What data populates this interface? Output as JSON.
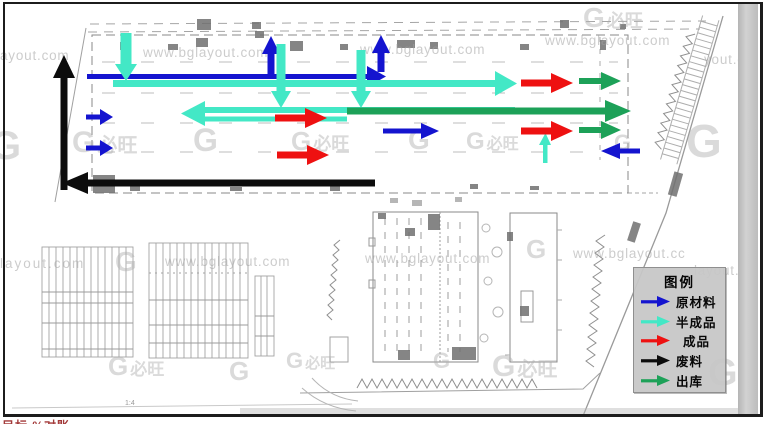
{
  "legend": {
    "title": "图例",
    "items": [
      {
        "key": "raw_material",
        "label": "原材料",
        "color": "#1414cf"
      },
      {
        "key": "semi_finished",
        "label": "半成品",
        "color": "#43e8c6"
      },
      {
        "key": "finished",
        "label": "成品",
        "color": "#ee1111"
      },
      {
        "key": "waste",
        "label": "废料",
        "color": "#0c0c0c"
      },
      {
        "key": "outbound",
        "label": "出库",
        "color": "#1da158"
      }
    ]
  },
  "flow_colors": {
    "raw_material": "#1414cf",
    "semi_finished": "#43e8c6",
    "finished": "#ee1111",
    "waste": "#0c0c0c",
    "outbound": "#1da158"
  },
  "watermarks": {
    "logo_g": "G",
    "logo_cn": "必旺",
    "texts": [
      "ayout.com",
      "www.bglayout.com",
      "www.bglayout.com",
      "www.bglayout.com",
      "yout.co",
      "layout.com",
      "www.bglayout.com",
      "www.bglayout.com",
      "www.bglayout.cc",
      "layout.cc"
    ]
  },
  "annotations": {
    "scale_note": "1:4",
    "clipped_caption": "目标 %对账"
  }
}
